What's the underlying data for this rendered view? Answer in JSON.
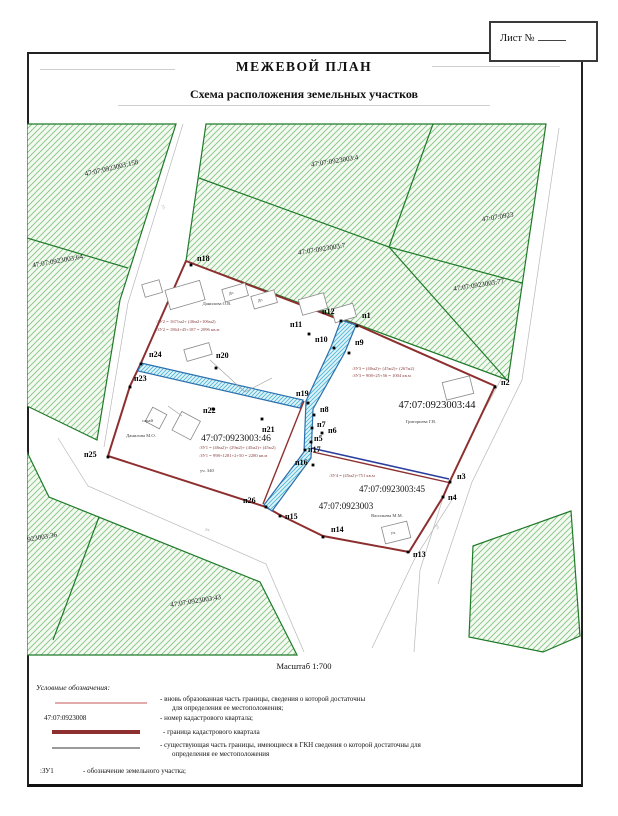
{
  "page": {
    "sheet_label": "Лист №",
    "title": "МЕЖЕВОЙ ПЛАН",
    "subtitle": "Схема расположения земельных участков",
    "scale_label": "Масштаб 1:700"
  },
  "parcels": {
    "p158": "47:07:0923003:158",
    "p4": "47:07:0923003:4",
    "p0923": "47:07:0923",
    "p7": "47:07:0923003:7",
    "p77": "47:07:0923003:77",
    "p64": "47:07:0923003:64",
    "p44": "47:07:0923003:44",
    "p46": "47:07:0923003:46",
    "p45": "47:07:0923003:45",
    "p03": "47:07:0923003",
    "p36": "47:07:0923003:36",
    "p43": "47:07:0923003:43"
  },
  "owners": {
    "danilova_ov": "Данилова О.В.",
    "danilova_mo": "Данилова М.О.",
    "grigoreva": "Григорьева Г.В.",
    "vasileva": "Васильева М.М."
  },
  "annotations": {
    "zu2_line1": ":ЗУ2 = 1671м2+ (46м2+106м2)",
    "zu2_line2": ":ЗУ2 = 1864+45+187 = 2096 кв.м",
    "zu3_line1": ":ЗУ3 = (40м2)+ (45м2)+ (267м2)",
    "zu3_line2": ":ЗУ3 = 908+25+56 = 1004 кв.м",
    "zu1_line1": ":ЗУ1 = (46м2)+ (29м2)+ (45м2)+ (45м2)",
    "zu1_line2": ":ЗУ1 = 998+1281+2+50 = 2280 кв.м",
    "zu4_line1": ":ЗУ4 = (45м2)+751 кв.м",
    "uch340": "уч. 340",
    "saray": "сарай",
    "shed1": "Дн",
    "shed2": "Дп",
    "uch": "уч.",
    "street": "ул."
  },
  "points": {
    "p1": "п1",
    "p2": "п2",
    "p3": "п3",
    "p4": "п4",
    "p5": "п5",
    "p6": "п6",
    "p7": "п7",
    "p8": "п8",
    "p9": "п9",
    "p10": "п10",
    "p11": "п11",
    "p12": "п12",
    "p13": "п13",
    "p14": "п14",
    "p15": "п15",
    "p16": "п16",
    "p17": "п17",
    "p18": "п18",
    "p19": "п19",
    "p20": "п20",
    "p21": "п21",
    "p22": "п22",
    "p23": "п23",
    "p24": "п24",
    "p25": "п25",
    "p26": "п26"
  },
  "legend": {
    "heading": "Условные обозначения:",
    "item1_line1": "- вновь образованная часть границы, сведения о которой достаточны",
    "item1_line2": "для определения ее местоположения;",
    "item2_symbol": "47:07:0923008",
    "item2_text": "- номер кадастрового квартала;",
    "item3_text": "- граница кадастрового квартала",
    "item4_line1": "- существующая часть границы, имеющиеся в ГКН сведения о которой достаточны для",
    "item4_line2": "определения ее местоположения",
    "item5_symbol": ":ЗУ1",
    "item5_text": "- обозначение земельного участка;"
  },
  "colors": {
    "quarter_border": "#8e2f2f",
    "parcel_border": "#1f7a28",
    "new_boundary": "#2b6fae",
    "existing_boundary": "#2b3f9e"
  }
}
